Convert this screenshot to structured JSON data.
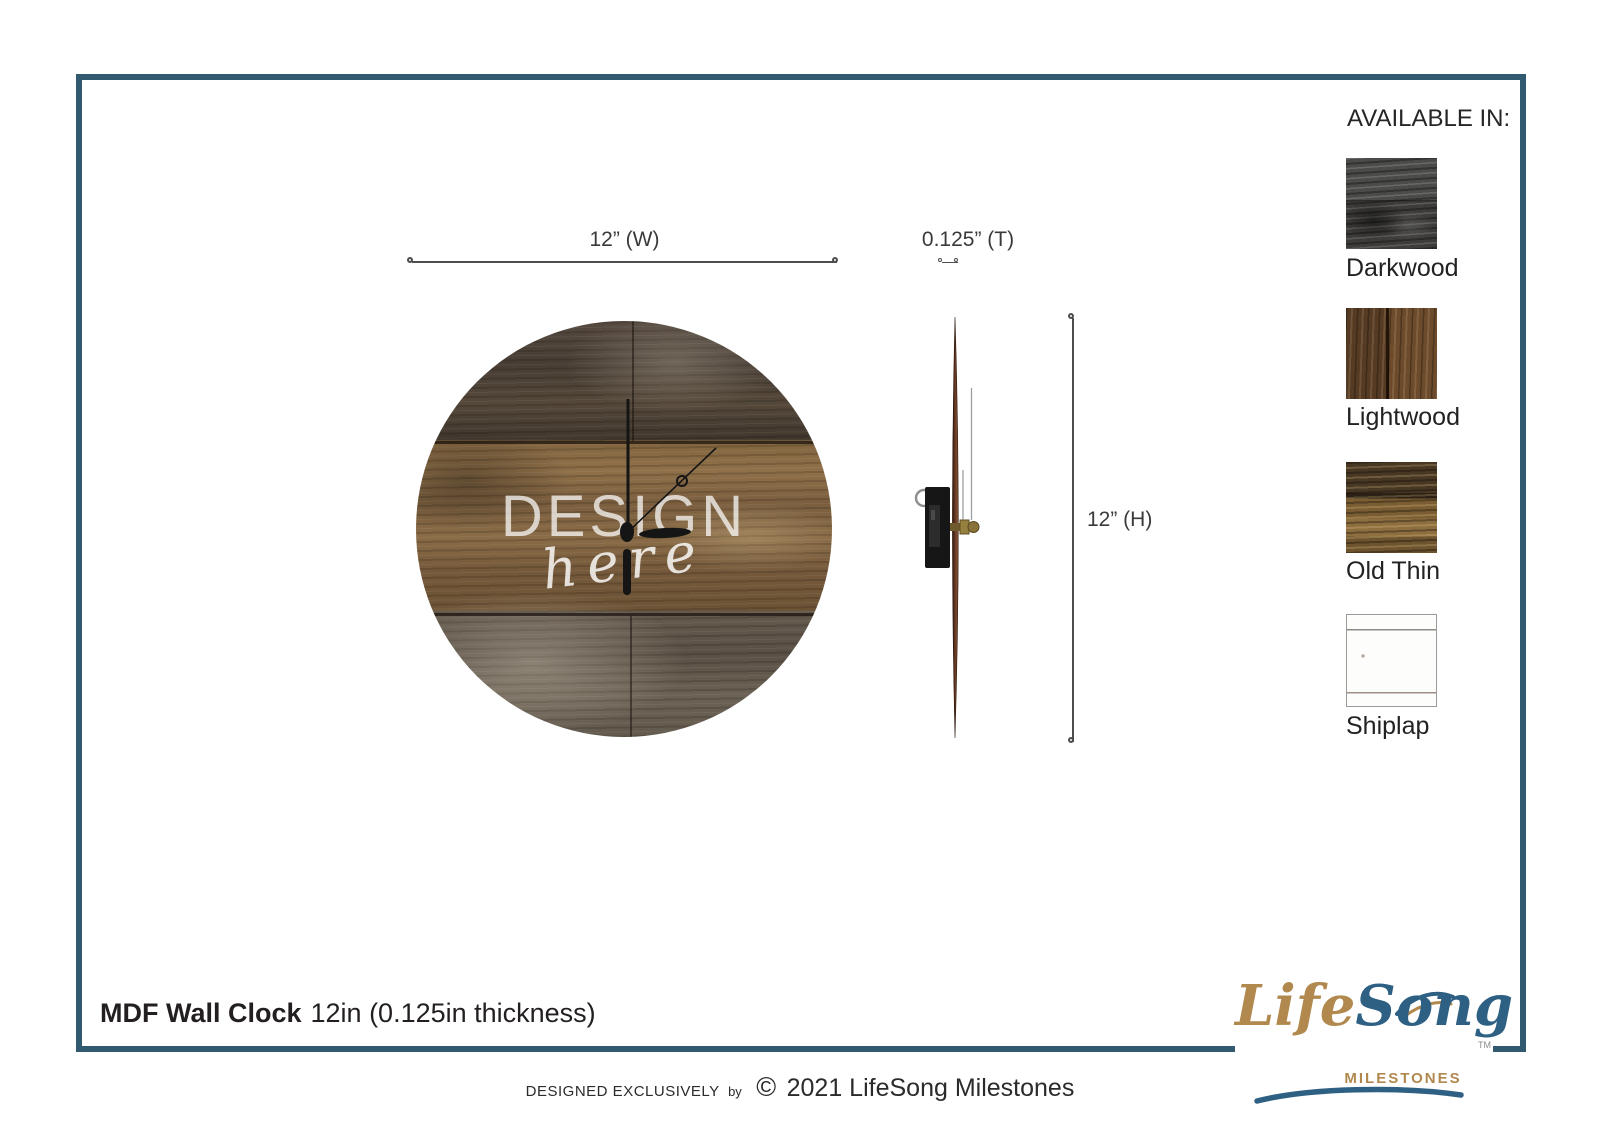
{
  "dimensions": {
    "width": "12” (W)",
    "thickness": "0.125” (T)",
    "height": "12” (H)"
  },
  "clock": {
    "watermark_line1": "DESIGN",
    "watermark_line2": "here"
  },
  "available": {
    "heading": "AVAILABLE IN:",
    "options": [
      {
        "name": "Darkwood"
      },
      {
        "name": "Lightwood"
      },
      {
        "name": "Old Thin"
      },
      {
        "name": "Shiplap"
      }
    ]
  },
  "title": {
    "product": "MDF Wall Clock",
    "spec": "12in (0.125in thickness)"
  },
  "logo": {
    "life": "Life",
    "song": "Song",
    "tm": "TM",
    "milestones": "MILESTONES"
  },
  "footer": {
    "designed": "DESIGNED EXCLUSIVELY",
    "by": "by",
    "symbol": "©",
    "text": "2021 LifeSong Milestones"
  },
  "colors": {
    "frame": "#315a70",
    "logo_gold": "#b1894f",
    "logo_blue": "#2e6084",
    "dimension_line": "#4d4d4d"
  }
}
